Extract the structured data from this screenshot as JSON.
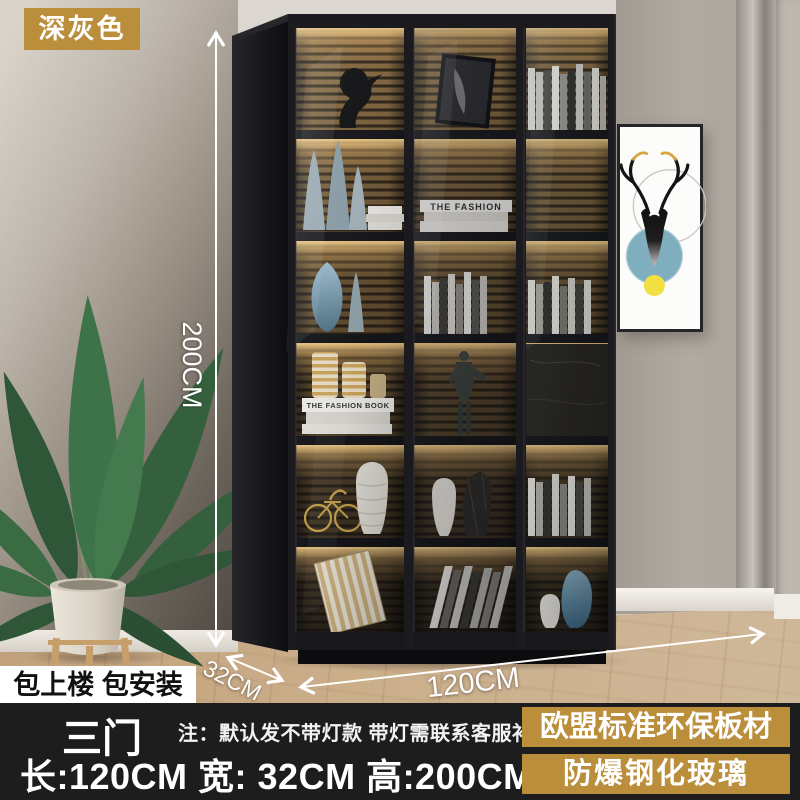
{
  "overlay": {
    "color_badge": "深灰色",
    "service_badge": "包上楼 包安装",
    "doors_badge": "三门",
    "note": "注：默认发不带灯款 带灯需联系客服补差价",
    "size_line": "长:120CM  宽: 32CM  高:200CM",
    "feature_badge_board": "欧盟标准环保板材",
    "feature_badge_glass": "防爆钢化玻璃"
  },
  "dimensions": {
    "height": "200CM",
    "depth": "32CM",
    "width": "120CM"
  },
  "decor_text": {
    "book_spine": "THE FASHION",
    "book_stack": "THE FASHION BOOK"
  },
  "colors": {
    "badge_gold": "#BB8E3C",
    "bottom_bar": "#1D1D1D",
    "led_warm": "#E8C27E",
    "art_blue": "#7FAEBF",
    "art_yellow": "#F2E042"
  }
}
